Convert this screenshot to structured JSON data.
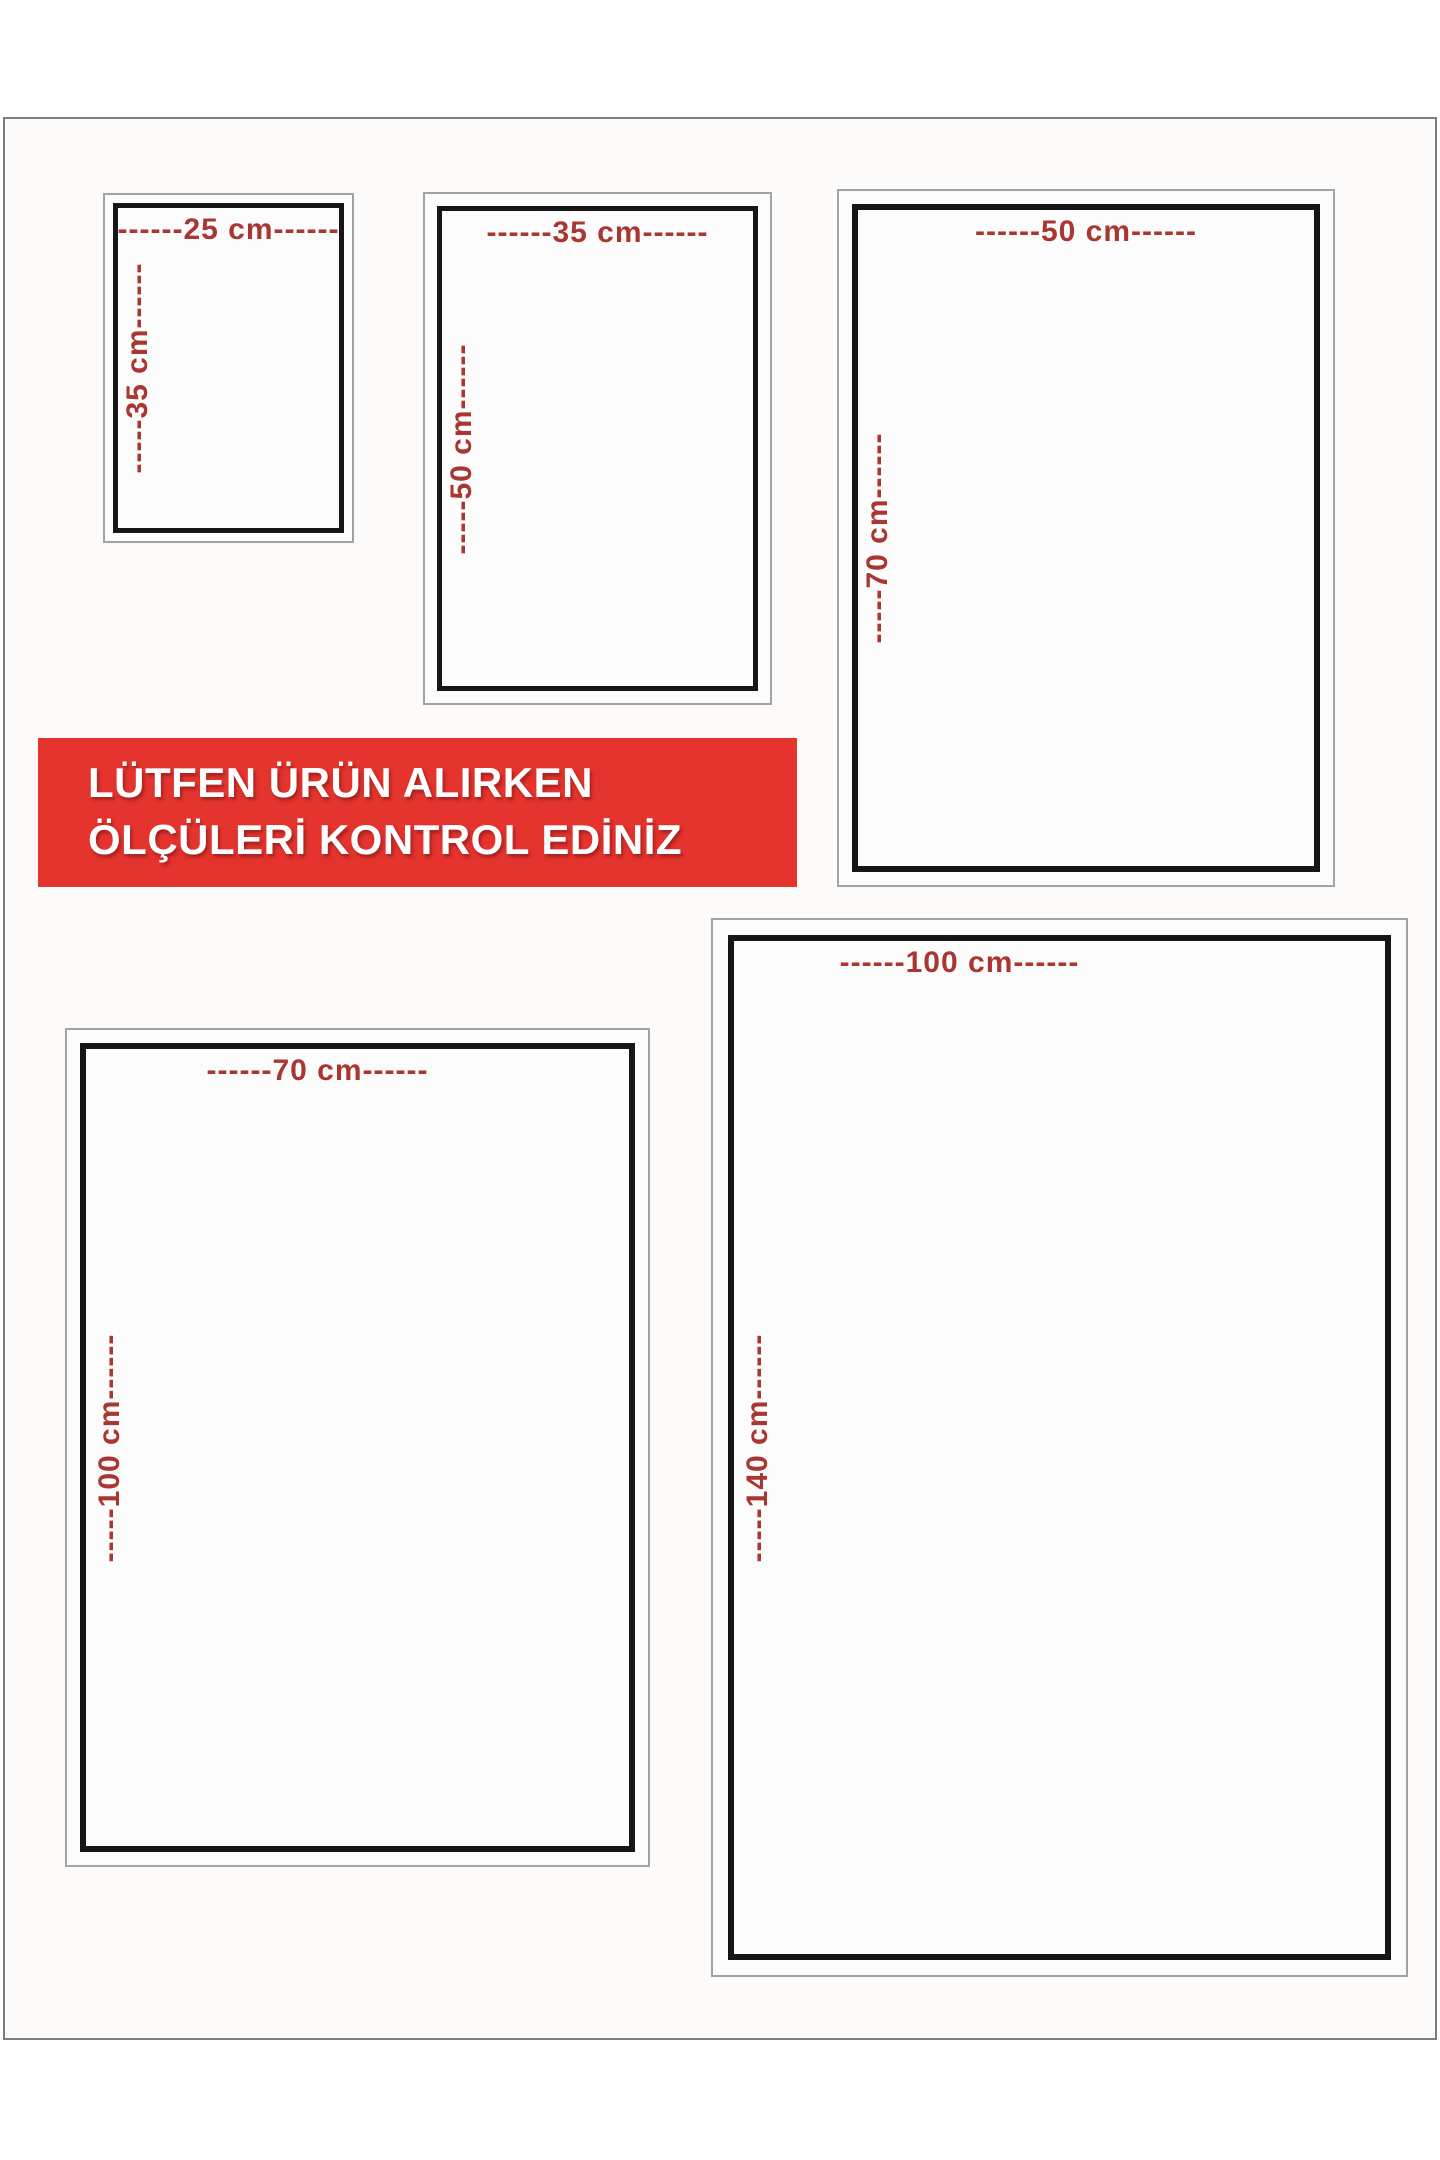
{
  "banner": {
    "line1": "LÜTFEN ÜRÜN ALIRKEN",
    "line2": "ÖLÇÜLERİ KONTROL EDİNİZ",
    "bg_color": "#e5332e",
    "text_color": "#ffffff"
  },
  "colors": {
    "dimension_text": "#a93630",
    "box_inner_border": "#161616",
    "box_outer_border": "#a3a3a3",
    "card_border": "#7d7d7d"
  },
  "size_boxes": [
    {
      "width_cm": 25,
      "height_cm": 35,
      "width_label": "------25 cm------",
      "height_label": "-----35 cm------"
    },
    {
      "width_cm": 35,
      "height_cm": 50,
      "width_label": "------35 cm------",
      "height_label": "-----50 cm------"
    },
    {
      "width_cm": 50,
      "height_cm": 70,
      "width_label": "------50 cm------",
      "height_label": "-----70 cm------"
    },
    {
      "width_cm": 70,
      "height_cm": 100,
      "width_label": "------70 cm------",
      "height_label": "-----100 cm------"
    },
    {
      "width_cm": 100,
      "height_cm": 140,
      "width_label": "------100 cm------",
      "height_label": "-----140 cm------"
    }
  ]
}
